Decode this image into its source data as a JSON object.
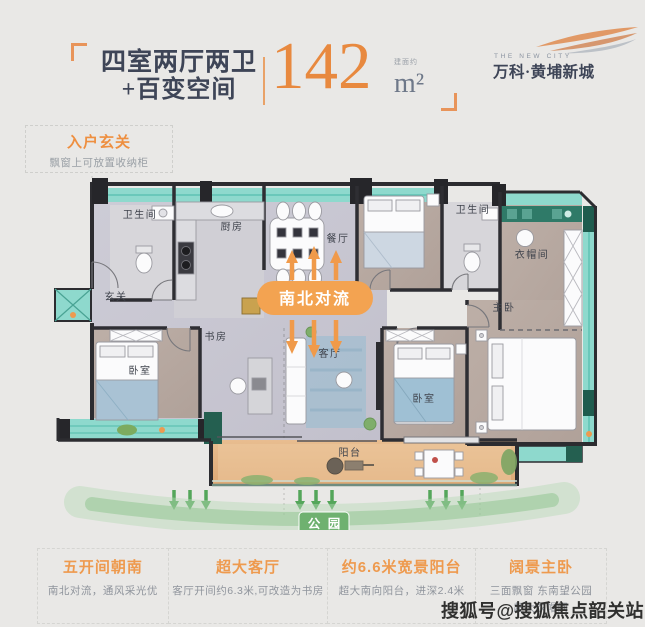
{
  "header": {
    "title_line1": "四室两厅两卫",
    "title_line2": "+百变空间",
    "area_prefix": "建面约",
    "area_value": "142",
    "area_unit": "m²"
  },
  "logo": {
    "tagline": "THE NEW CITY",
    "name": "万科·黄埔新城"
  },
  "entry_callout": {
    "title": "入户玄关",
    "subtitle": "飘窗上可放置收纳柜"
  },
  "floorplan": {
    "flow_badge": "南北对流",
    "park_badge": "公 园",
    "rooms": {
      "entry": "玄关",
      "bath_top": "卫生间",
      "kitchen": "厨房",
      "dining": "餐厅",
      "bath_right": "卫生间",
      "cloakroom": "衣帽间",
      "master": "主卧",
      "bedroom_left": "卧室",
      "study": "书房",
      "living": "客厅",
      "bedroom_mid": "卧室",
      "balcony": "阳台"
    }
  },
  "features": [
    {
      "title": "五开间朝南",
      "desc": "南北对流，通风采光优",
      "desc2": ""
    },
    {
      "title": "超大客厅",
      "desc": "客厅开间约6.3米,可改造为书房",
      "desc2": ""
    },
    {
      "title": "约6.6米宽景阳台",
      "desc": "超大南向阳台，进深2.4米",
      "desc2": ""
    },
    {
      "title": "阔景主卧",
      "desc": "三面飘窗 东南望公园",
      "desc2": "超大衣帽间"
    }
  ],
  "watermark": "搜狐号@搜狐焦点韶关站",
  "colors": {
    "accent_orange": "#ee9a4e",
    "teal_window": "#8ed9cd",
    "dark_green": "#225e50",
    "park_green": "#6fb170",
    "arrow_green": "#54a65a",
    "wall": "#2c2c30",
    "balcony_tan": "#e4b486"
  }
}
